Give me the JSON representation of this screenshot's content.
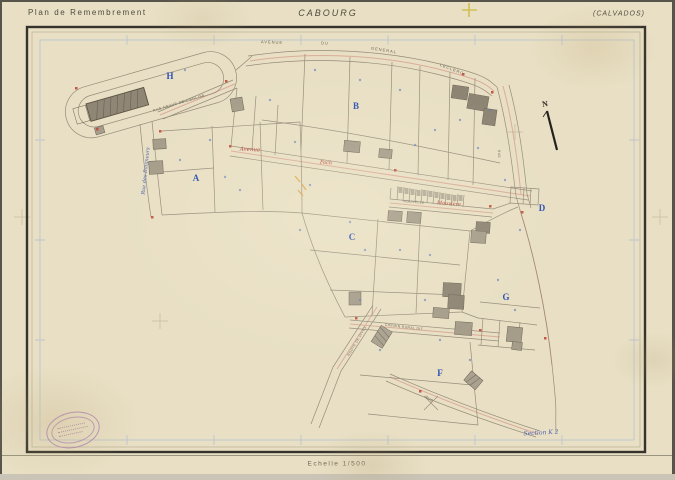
{
  "header": {
    "plan_title": "Plan de Remembrement",
    "commune": "CABOURG",
    "department": "(CALVADOS)"
  },
  "footer": {
    "scale_label": "Echelle 1/500"
  },
  "compass": {
    "north_label": "N"
  },
  "sections": [
    {
      "label": "H"
    },
    {
      "label": "A"
    },
    {
      "label": "B"
    },
    {
      "label": "C"
    },
    {
      "label": "D"
    },
    {
      "label": "G"
    },
    {
      "label": "F"
    }
  ],
  "streets": [
    {
      "name": "AVENUE"
    },
    {
      "name": "DU"
    },
    {
      "name": "GENERAL"
    },
    {
      "name": "LECLERC"
    },
    {
      "name": "RUE NEUVE DE L'EGLISE"
    },
    {
      "name": "Rue des Baigneurs"
    },
    {
      "name": "Avenue"
    },
    {
      "name": "Foch"
    },
    {
      "name": "NOUVELLE"
    },
    {
      "name": "Mauvière"
    },
    {
      "name": "CHEMIN RURAL DIT"
    },
    {
      "name": "ROUTE DE DIVES"
    },
    {
      "name": "RUE"
    },
    {
      "name": "RUE"
    }
  ],
  "annotations": {
    "section_note": "Section K 2"
  },
  "colors": {
    "paper": "#e8dfc4",
    "frame_ink": "#35332c",
    "map_ink": "#8e8473",
    "section_blue": "#2d50b2",
    "street_red": "#b8453a",
    "handwriting_blue": "#4a63ae",
    "pink_pencil": "#cc7b72",
    "stamp_purple": "#a06bb0",
    "accent_yellow": "#cfbc45",
    "accent_orange": "#dba23a"
  }
}
